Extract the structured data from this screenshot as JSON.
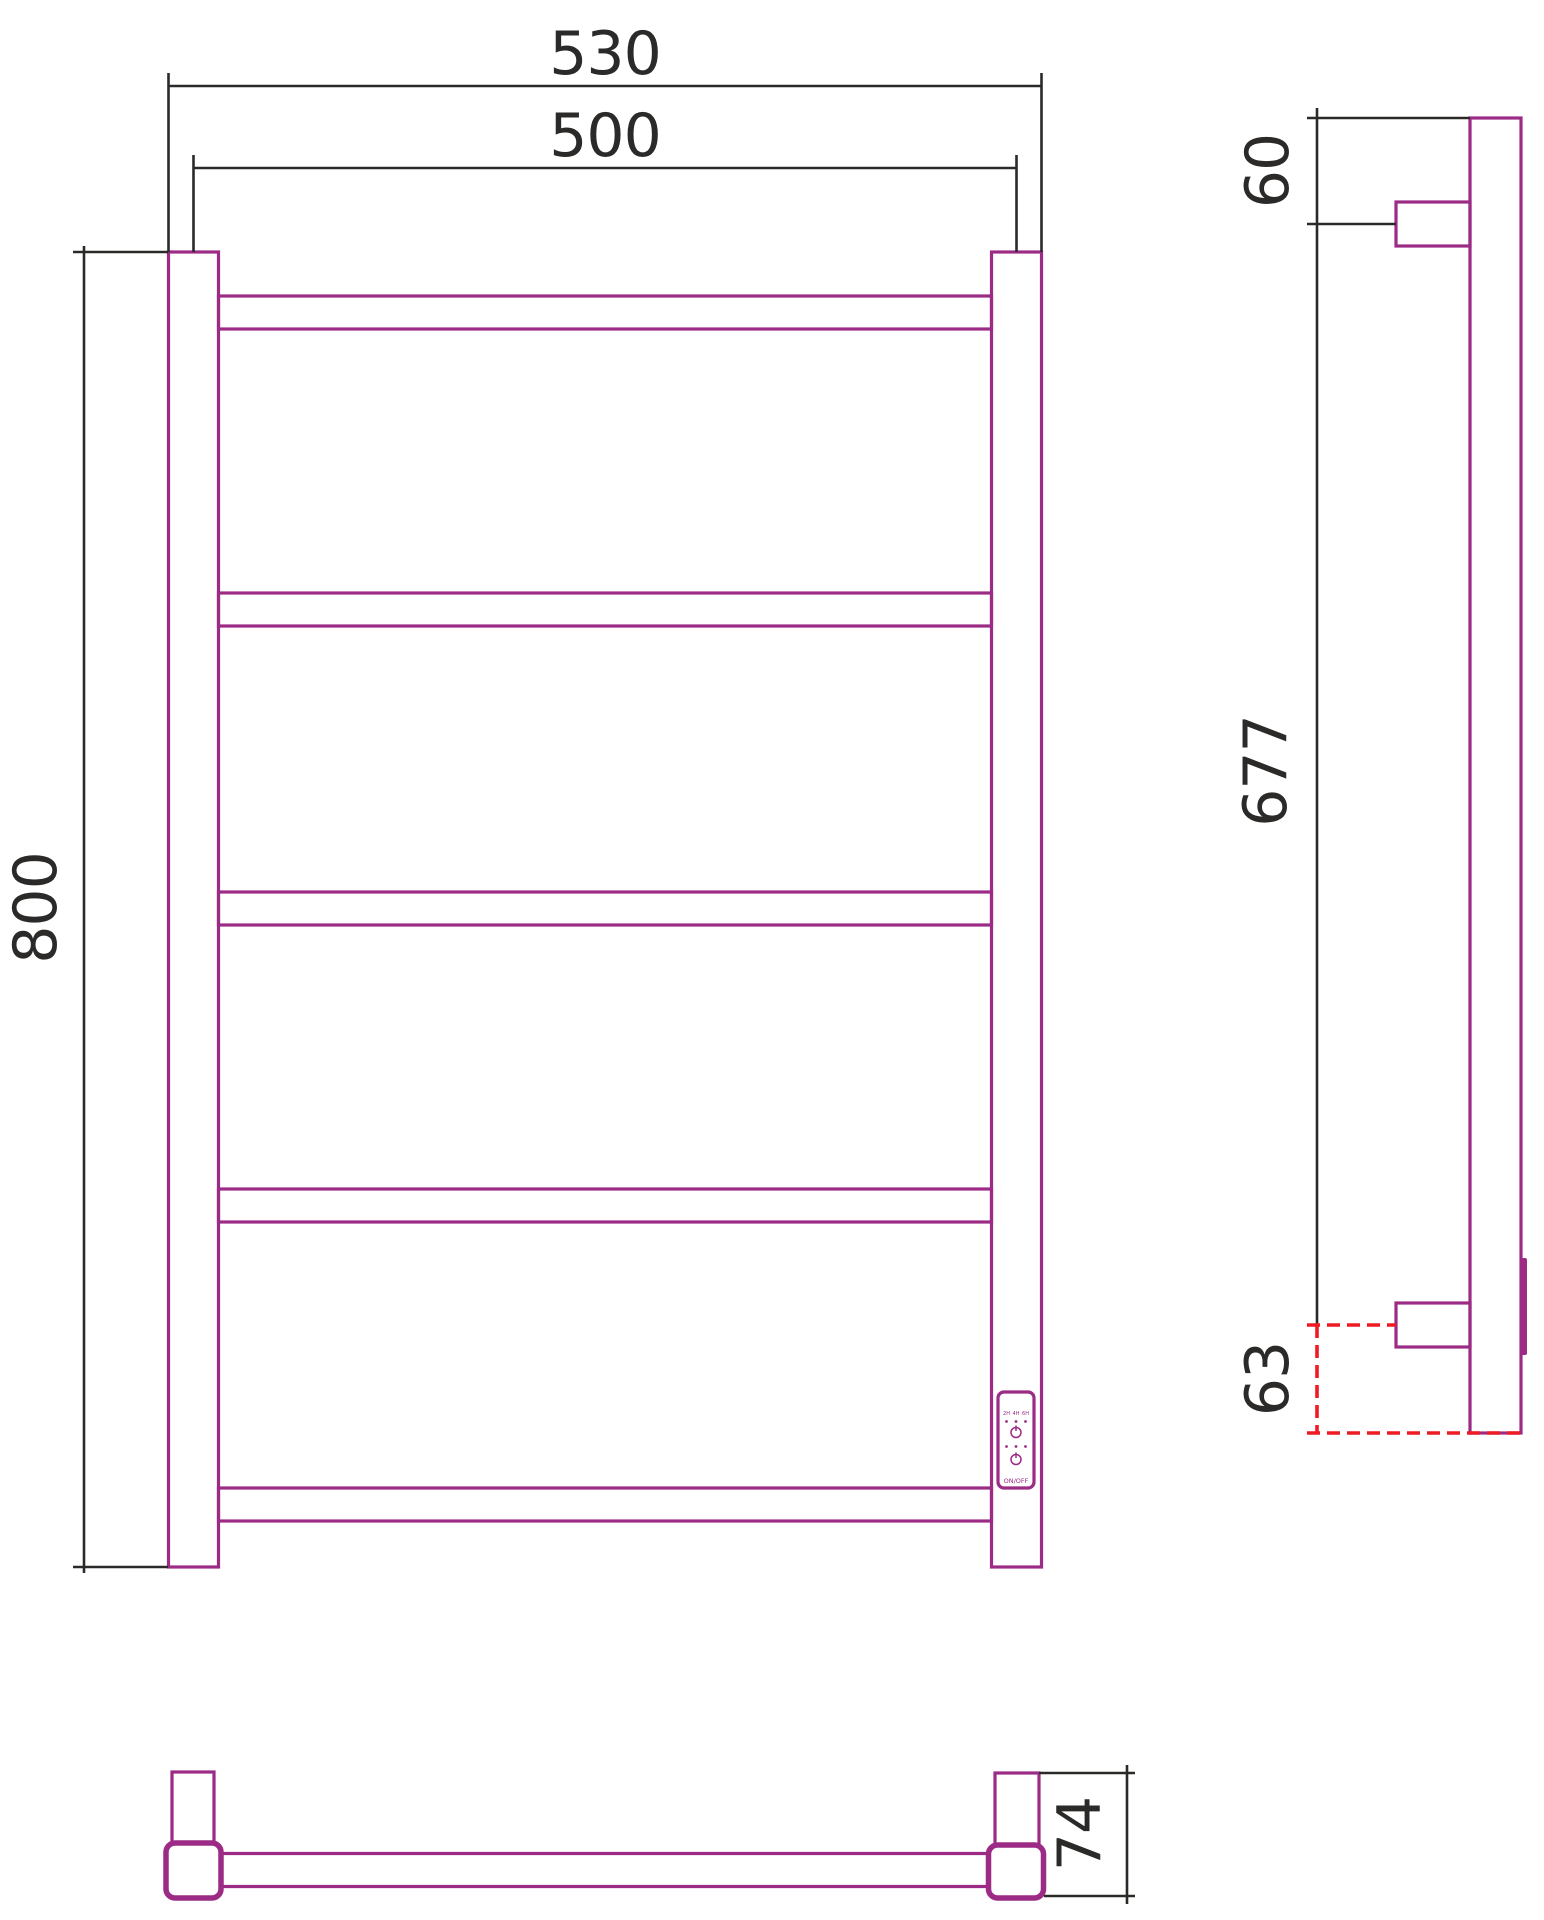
{
  "drawing": {
    "type": "technical-drawing",
    "subject": "ladder-style electric heated towel rail, three orthographic views",
    "colors": {
      "product": "#9b2b85",
      "dimension_lines": "#2b2a29",
      "detail_highlight": "#ed1c24",
      "background": "#ffffff"
    },
    "views": {
      "front": {
        "dim_outer_width": "530",
        "dim_center_width": "500",
        "dim_height": "800",
        "rung_count": 5
      },
      "side": {
        "dim_top_to_bracket": "60",
        "dim_bracket_span": "677",
        "dim_bracket_to_bottom": "63"
      },
      "bottom": {
        "dim_depth": "74"
      }
    },
    "control_panel": {
      "timer_labels": [
        "2H",
        "4H",
        "6H"
      ],
      "power_label": "ON/OFF"
    }
  }
}
